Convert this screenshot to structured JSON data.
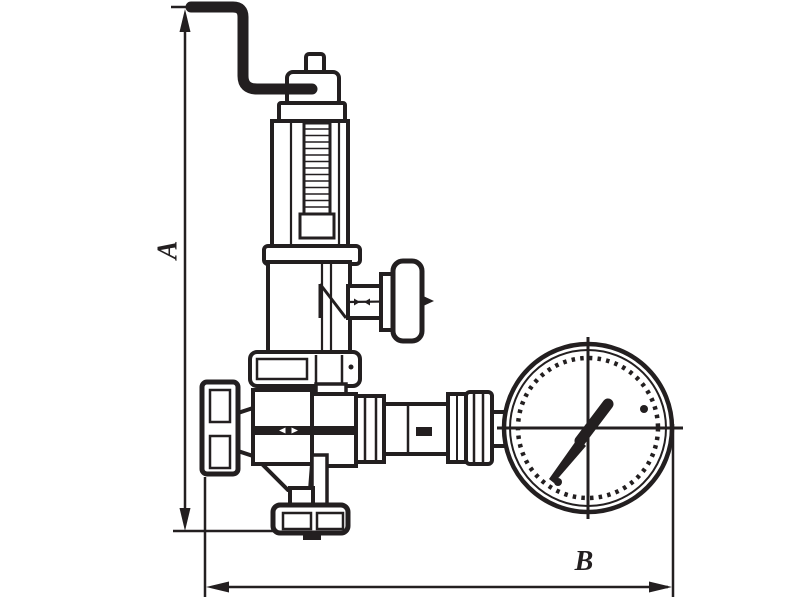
{
  "drawing": {
    "title": "Valve dimensional drawing",
    "subject": "Spring safety valve with bent test rod, side adjusting knob and pressure gauge",
    "ink_color": "#231f20",
    "background_color": "#ffffff",
    "dimension_labels": {
      "height": "A",
      "width": "B"
    },
    "parts": [
      {
        "name": "test-rod",
        "description": "bent rod at top of valve"
      },
      {
        "name": "bonnet-cap",
        "description": "cap with stem at top of spring bonnet"
      },
      {
        "name": "spring-bonnet",
        "description": "tall cylinder with threaded spindle"
      },
      {
        "name": "side-knob",
        "description": "T-knob on side outlet"
      },
      {
        "name": "hex-flange",
        "description": "hexagonal body flange"
      },
      {
        "name": "valve-body",
        "description": "central body with facet band"
      },
      {
        "name": "inlet-union-nut",
        "description": "left connection nut"
      },
      {
        "name": "bottom-cap-nut",
        "description": "bottom connection nut"
      },
      {
        "name": "gauge-connection",
        "description": "right outlet run with nuts and tube"
      },
      {
        "name": "pressure-gauge",
        "description": "round gauge with needle and tick ring"
      }
    ]
  }
}
